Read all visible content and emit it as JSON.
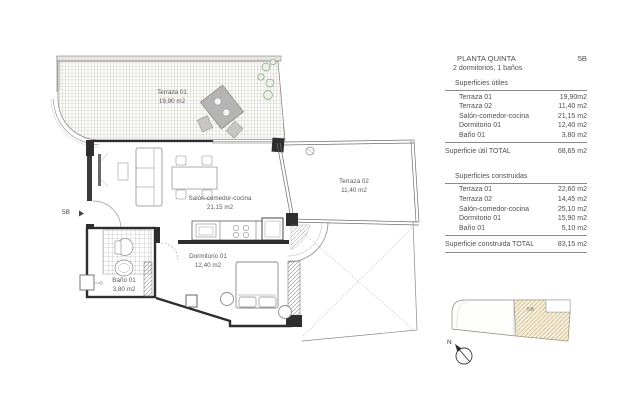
{
  "panel": {
    "title": "PLANTA QUINTA",
    "unit": "5B",
    "subtitle": "2 dormitorios, 1 baños",
    "useful": {
      "heading": "Superficies útiles",
      "rows": [
        {
          "label": "Terraza 01",
          "value": "19,90m2"
        },
        {
          "label": "Terraza 02",
          "value": "11,40 m2"
        },
        {
          "label": "Salón-comedor-cocina",
          "value": "21,15 m2"
        },
        {
          "label": "Dormitorio 01",
          "value": "12,40 m2"
        },
        {
          "label": "Baño 01",
          "value": "3,80 m2"
        }
      ],
      "total_label": "Superficie útil TOTAL",
      "total_value": "68,65 m2"
    },
    "built": {
      "heading": "Superficies construidas",
      "rows": [
        {
          "label": "Terraza 01",
          "value": "22,60 m2"
        },
        {
          "label": "Terraza 02",
          "value": "14,45 m2"
        },
        {
          "label": "Salón-comedor-cocina",
          "value": "25,10 m2"
        },
        {
          "label": "Dormitorio 01",
          "value": "15,90 m2"
        },
        {
          "label": "Baño 01",
          "value": "5,10 m2"
        }
      ],
      "total_label": "Superficie construida TOTAL",
      "total_value": "83,15 m2"
    }
  },
  "plan": {
    "rooms": [
      {
        "name": "Terraza 01",
        "area": "19,90 m2"
      },
      {
        "name": "Terraza 02",
        "area": "11,40 m2"
      },
      {
        "name": "Salón-comedor-cocina",
        "area": "21,15 m2"
      },
      {
        "name": "Dormitorio 01",
        "area": "12,40 m2"
      },
      {
        "name": "Baño 01",
        "area": "3,80 m2"
      }
    ],
    "entry_label": "5B",
    "entry_arrow": "▸"
  },
  "keyplan": {
    "unit_label": "5B",
    "north_label": "N"
  },
  "colors": {
    "wall": "#2e2e2e",
    "line": "#777777",
    "terrace_hatch": "#c2bbae",
    "keyplan_hatch": "#cdb483",
    "keyplan_fill": "#f8f3e2",
    "plant_green": "#7fa07f"
  }
}
